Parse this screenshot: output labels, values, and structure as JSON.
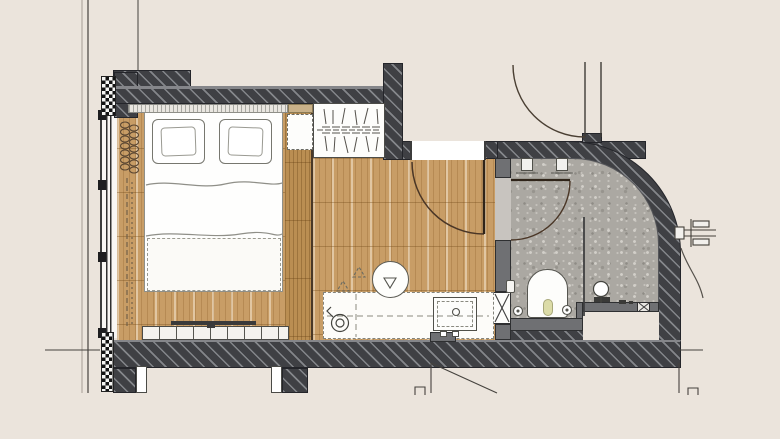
{
  "meta": {
    "type": "architectural-floor-plan",
    "view": "top-down",
    "subject": "hotel-room-with-bathroom"
  },
  "rooms": [
    {
      "name": "bedroom",
      "floor_material": "wood-plank"
    },
    {
      "name": "entry-hall",
      "floor_material": "wood-plank"
    },
    {
      "name": "bathroom",
      "floor_material": "terrazzo-stone"
    },
    {
      "name": "corridor",
      "floor_material": "unfinished"
    }
  ],
  "fixtures": [
    "double-bed",
    "pillow-left",
    "pillow-right",
    "upholstered-headboard",
    "duvet",
    "foot-throw",
    "radiator-coil",
    "curtain-track",
    "window-wall",
    "masonry-pier-top",
    "masonry-pier-bottom",
    "wardrobe-hanging-rail",
    "overhead-cabinet-dashed",
    "side-shelf",
    "tv",
    "tv-console",
    "vanity-counter",
    "round-washbasin",
    "faucet-mark",
    "kettle",
    "minibar",
    "entrance-door",
    "corridor-door",
    "bathroom-door",
    "rain-shower-heads",
    "glass-screen",
    "wall-hung-wc",
    "flush-plate",
    "floor-drains",
    "hand-shower-mixer",
    "service-shaft-x",
    "bench-ledge",
    "wall-connection-detail",
    "reference-lines",
    "door-swing-marks"
  ],
  "colors": {
    "background": "#EBE4DC",
    "wall_dark": "#3F4044",
    "wall_hatch": "#C8CBD0",
    "partition_gray": "#6F7073",
    "wood_floor": "#C89D66",
    "wood_furniture": "#BA8E52",
    "terrazzo": "#ABA8A2",
    "fixture_white": "#FDFDFB",
    "door_line": "#4A3626",
    "annotation_line": "#4A443C"
  }
}
